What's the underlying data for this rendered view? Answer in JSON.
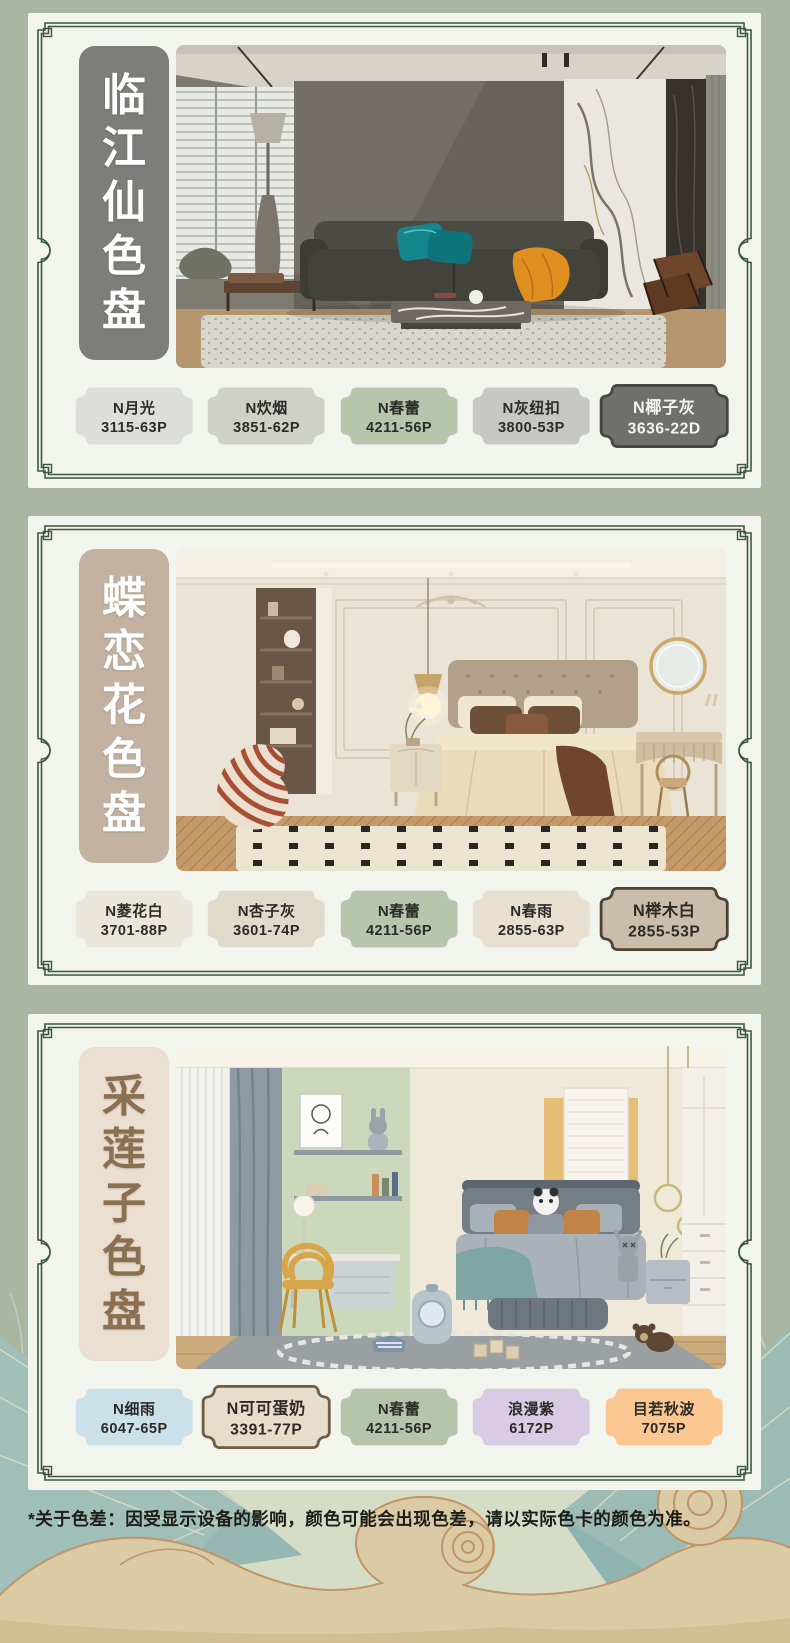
{
  "theme": {
    "page_bg": "#aab6a2",
    "card_bg": "#f2f4ee",
    "frame_color": "#3b5741",
    "sage_accent": "#b6c5ac"
  },
  "palettes": [
    {
      "title": "临江仙色盘",
      "title_bg": "#7d7d7b",
      "title_color": "#ffffff",
      "swatches": [
        {
          "name": "N月光",
          "code": "3115-63P",
          "color": "#dddeda",
          "text_color": "#2b2b28"
        },
        {
          "name": "N炊烟",
          "code": "3851-62P",
          "color": "#cfd0c8",
          "text_color": "#2b2b28"
        },
        {
          "name": "N春蕾",
          "code": "4211-56P",
          "color": "#b6c5ac",
          "text_color": "#2b2b28"
        },
        {
          "name": "N灰纽扣",
          "code": "3800-53P",
          "color": "#c6c7c3",
          "text_color": "#2b2b28"
        },
        {
          "name": "N椰子灰",
          "code": "3636-22D",
          "color": "#6f6f6b",
          "text_color": "#f4f4f2",
          "border": "#454542"
        }
      ]
    },
    {
      "title": "蝶恋花色盘",
      "title_bg": "#c3b2a2",
      "title_color": "#ffffff",
      "swatches": [
        {
          "name": "N菱花白",
          "code": "3701-88P",
          "color": "#ebe6dc",
          "text_color": "#2b2b28"
        },
        {
          "name": "N杏子灰",
          "code": "3601-74P",
          "color": "#e0dacb",
          "text_color": "#2b2b28"
        },
        {
          "name": "N春蕾",
          "code": "4211-56P",
          "color": "#b6c5ac",
          "text_color": "#2b2b28"
        },
        {
          "name": "N春雨",
          "code": "2855-63P",
          "color": "#e7dfcf",
          "text_color": "#2b2b28"
        },
        {
          "name": "N榉木白",
          "code": "2855-53P",
          "color": "#cabdac",
          "text_color": "#2e2a24",
          "border": "#4e4233"
        }
      ]
    },
    {
      "title": "采莲子色盘",
      "title_bg": "#ebdfd1",
      "title_color": "#8a6f50",
      "swatches": [
        {
          "name": "N细雨",
          "code": "6047-65P",
          "color": "#cbe0e9",
          "text_color": "#2b2b28"
        },
        {
          "name": "N可可蛋奶",
          "code": "3391-77P",
          "color": "#e7ddcc",
          "text_color": "#2e2a24",
          "border": "#6f5c42"
        },
        {
          "name": "N春蕾",
          "code": "4211-56P",
          "color": "#b5c4ab",
          "text_color": "#2b2b28"
        },
        {
          "name": "浪漫紫",
          "code": "6172P",
          "color": "#d8cbe3",
          "text_color": "#2b2b28"
        },
        {
          "name": "目若秋波",
          "code": "7075P",
          "color": "#fac792",
          "text_color": "#2b2b28"
        }
      ]
    }
  ],
  "footer": {
    "disclaimer": "*关于色差：因受显示设备的影响，颜色可能会出现色差，请以实际色卡的颜色为准。"
  }
}
